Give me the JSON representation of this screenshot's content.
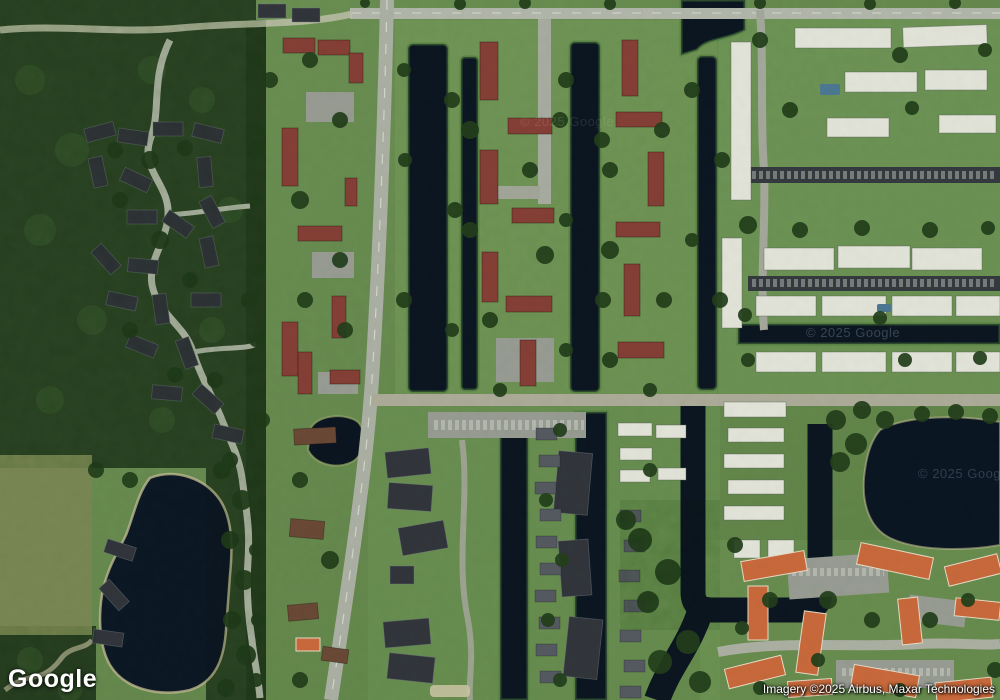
{
  "viewport": {
    "width": 1000,
    "height": 700,
    "map_mode": "satellite"
  },
  "overlays": {
    "logo_text": "Google",
    "attribution_text": "Imagery ©2025 Airbus, Maxar Technologies",
    "watermark_center": "© 2025 Google",
    "watermark_canal": "© 2025 Google",
    "watermark_lake": "© 2025 Goog"
  },
  "palette": {
    "grass": "#6b8f54",
    "forest": "#2e4827",
    "olive_field": "#7d8a57",
    "water": "#0b1622",
    "road": "#b7bab0",
    "red_roof": "#8a4138",
    "dark_roof": "#33373e",
    "white_roof": "#ebebe4",
    "orange_roof": "#d06c3e",
    "brown_roof": "#6e4a38",
    "sand_shore": "#cdc49c"
  }
}
